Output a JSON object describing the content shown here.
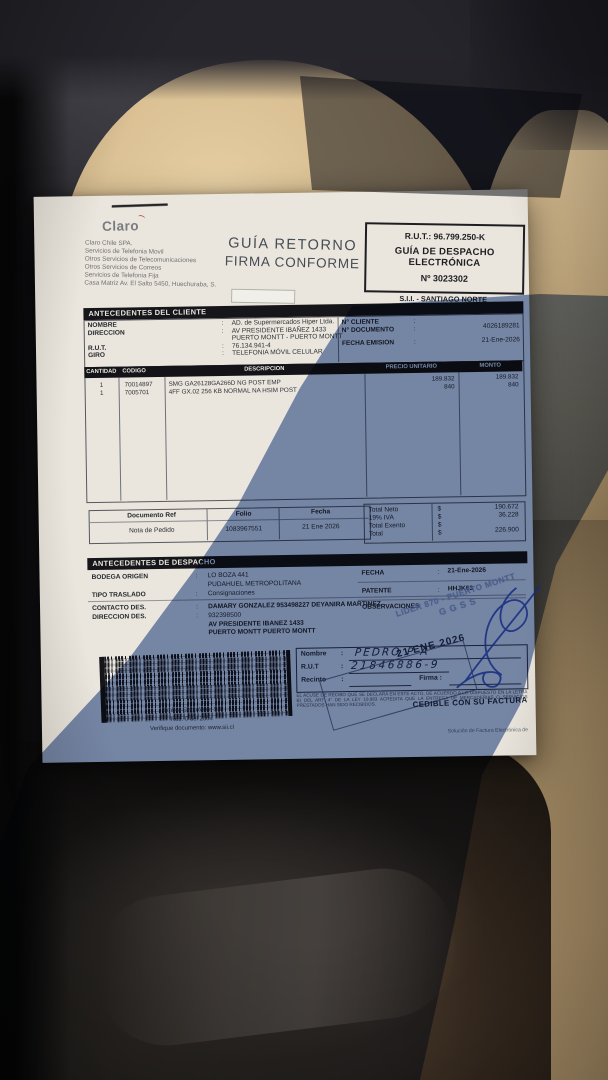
{
  "palette": {
    "paper_lit": "#eae6dd",
    "shadow_tint": "#7f93bd",
    "seat_tan": "#d3b78a",
    "jacket_brown": "#211a14",
    "pen_blue": "#2a49ad",
    "stamp_ink": "#96a1bc",
    "bar_black": "#16161a"
  },
  "punct": {
    "colon": ":"
  },
  "header": {
    "logo": "Claro",
    "company_lines": [
      "Claro Chile SPA.",
      "Servicios de Telefonia Movil",
      "Otros Servicios de Telecomunicaciones",
      "Otros Servicios de Correos",
      "Servicios de Telefonia Fija",
      "Casa Matriz Av. El Salto 5450, Huechuraba, S."
    ],
    "return_stamp": {
      "line1": "GUÍA RETORNO",
      "line2": "FIRMA CONFORME"
    },
    "rut_box": {
      "rut": "R.U.T.: 96.799.250-K",
      "type1": "GUÍA DE DESPACHO",
      "type2": "ELECTRÓNICA",
      "number": "Nº 3023302"
    },
    "sii_office": "S.I.I. - SANTIAGO NORTE"
  },
  "client": {
    "title": "ANTECEDENTES DEL CLIENTE",
    "rows": [
      {
        "label": "NOMBRE",
        "sep": ":",
        "value": "AD. de Supermercados Hiper Ltda."
      },
      {
        "label": "DIRECCION",
        "sep": ":",
        "value": "AV PRESIDENTE IBAÑEZ 1433"
      },
      {
        "label": "",
        "sep": "",
        "value": "PUERTO MONTT -  PUERTO MONTT"
      },
      {
        "label": "R.U.T.",
        "sep": ":",
        "value": "76.134.941-4"
      },
      {
        "label": "GIRO",
        "sep": ":",
        "value": "TELEFONIA MÓVIL CELULAR"
      }
    ],
    "right_rows": [
      {
        "label": "N° CLIENTE",
        "sep": ":",
        "value": ""
      },
      {
        "label": "N° DOCUMENTO",
        "sep": ":",
        "value": "4026189281"
      },
      {
        "label": "FECHA EMISION",
        "sep": ":",
        "value": "21-Ene-2026"
      }
    ]
  },
  "items": {
    "columns": {
      "c1": "CANTIDAD",
      "c2": "CODIGO",
      "c3": "DESCRIPCION",
      "c4": "PRECIO UNITARIO",
      "c5": "MONTO"
    },
    "rows": [
      {
        "cantidad": "1",
        "codigo": "70014897",
        "descripcion": "SMG GA26128GA266D NG POST EMP",
        "precio": "189.832",
        "monto": "189.832"
      },
      {
        "cantidad": "1",
        "codigo": "7005701",
        "descripcion": "4FF GX.02 256 KB NORMAL NA HSIM POST",
        "precio": "840",
        "monto": "840"
      }
    ]
  },
  "reference": {
    "col1": "Documento Ref",
    "col2": "Folio",
    "col3": "Fecha",
    "doc": "Nota de Pedido",
    "folio": "1083967551",
    "fecha": "21 Ene 2026"
  },
  "totals": {
    "rows": [
      {
        "label": "Total Neto",
        "cur": "$",
        "value": "190.672"
      },
      {
        "label": "19% IVA",
        "cur": "$",
        "value": "36.228"
      },
      {
        "label": "Total Exento",
        "cur": "$",
        "value": ""
      },
      {
        "label": "Total",
        "cur": "$",
        "value": "226.900"
      }
    ]
  },
  "dispatch": {
    "title": "ANTECEDENTES DE DESPACHO",
    "bodega_label": "BODEGA ORIGEN",
    "bodega_value": "LO BOZA 441",
    "bodega_value2": "PUDAHUEL  METROPOLITANA",
    "traslado_label": "TIPO TRASLADO",
    "traslado_value": "Consignaciones",
    "contacto_label": "CONTACTO DES.",
    "contacto_value": "DAMARY GONZALEZ 953498227 DEYANIRA MARTINEZ",
    "direccion_label": "DIRECCION DES.",
    "direccion_value": "932398500",
    "direccion_value2": "AV PRESIDENTE IBANEZ 1433",
    "direccion_value3": "PUERTO MONTT   PUERTO MONTT",
    "fecha_label": "FECHA",
    "fecha_value": "21-Ene-2026",
    "patente_label": "PATENTE",
    "patente_value": "HHJK63",
    "observaciones_label": "OBSERVACIONES"
  },
  "barcode": {
    "caption1": "Timbre Electrónico SII",
    "caption2": "Res. 0 del 2004",
    "caption3": "Verifique documento: www.sii.cl"
  },
  "reception": {
    "nombre_label": "Nombre",
    "rut_label": "R.U.T",
    "recinto_label": "Recinto",
    "firma_label": "Firma :",
    "hw_name": "PEDRO P A",
    "hw_rut": "21846886-9",
    "legal": "EL ACUSE DE RECIBO QUE SE DECLARA EN ESTE ACTO, DE ACUERDO A LO DISPUESTO EN LA LETRA B) DEL ART. 4° DE LA LEY 19.983 ACREDITA QUE LA ENTREGA DE MERCADERIAS O SERVICIOS PRESTADOS HAN SIDO RECIBIDOS."
  },
  "stamps": {
    "date_stamp": "21 ENE 2026",
    "lider_line1": "LIDER 870 - PUERTO MONTT",
    "lider_line2": "GGSS"
  },
  "cedible": "CEDIBLE CON SU FACTURA",
  "footer_note": "Solución de Factura Electrónica de"
}
